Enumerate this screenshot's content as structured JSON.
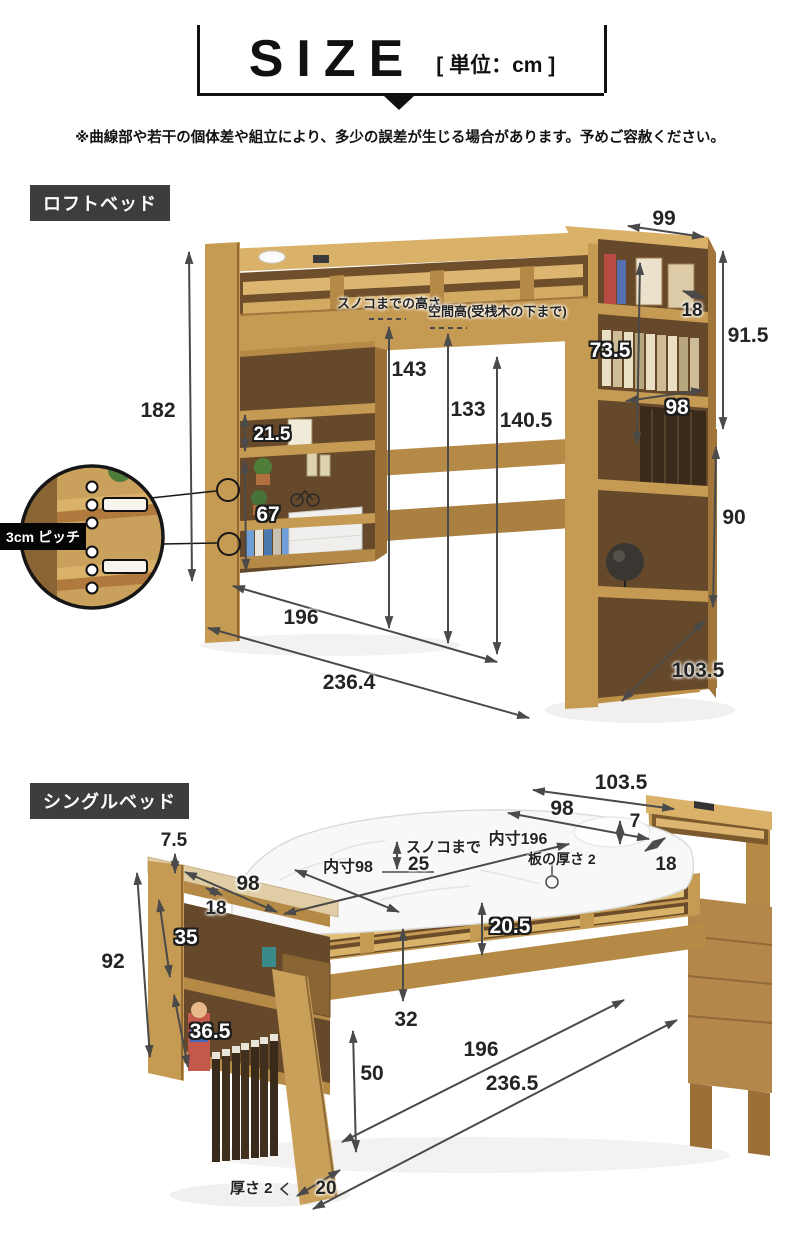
{
  "header": {
    "title": "SIZE",
    "unit": "[ 単位：cm ]"
  },
  "note": "※曲線部や若干の個体差や組立により、多少の誤差が生じる場合があります。予めご容赦ください。",
  "loft": {
    "label": "ロフトベッド",
    "annotations": {
      "sunoko_height_label": "スノコまでの高さ",
      "space_height_label": "空間高(受桟木の下まで)",
      "pitch_label": "3cm ピッチ"
    },
    "dims": {
      "top_width": "99",
      "shelf_depth": "18",
      "upper_height": "91.5",
      "shelf_inner_height": "73.5",
      "shelf_inner_width": "98",
      "lower_height": "90",
      "total_height": "182",
      "shelf_gap": "21.5",
      "shelf_column_height": "67",
      "sunoko_height": "143",
      "space_height": "133",
      "under_height": "140.5",
      "inner_width": "196",
      "total_width": "236.4",
      "depth": "103.5"
    }
  },
  "single": {
    "label": "シングルベッド",
    "annotations": {
      "inner_width_label": "内寸98",
      "sunoko_label": "スノコまで",
      "sunoko_value": "25",
      "inner_length_label": "内寸196",
      "board_thickness_label": "板の厚さ 2",
      "thickness_label": "厚さ 2"
    },
    "dims": {
      "depth": "103.5",
      "head_width": "98",
      "head_gap": "7",
      "head_depth": "18",
      "foot_cap_height": "7.5",
      "foot_width": "98",
      "foot_depth": "18",
      "rail_height": "20.5",
      "shelf_upper_height": "35",
      "total_height": "92",
      "shelf_lower_height": "36.5",
      "under_clearance": "32",
      "frame_floor_height": "50",
      "inner_length": "196",
      "total_length": "236.5",
      "leg_depth": "20"
    }
  },
  "colors": {
    "section_label_bg": "#3d3d3d",
    "arrow": "#4a4a4a",
    "wood_light": "#d9b169",
    "wood_mid": "#c59a52",
    "wood_dark": "#8a6534",
    "shelf_interior": "#66492b"
  }
}
